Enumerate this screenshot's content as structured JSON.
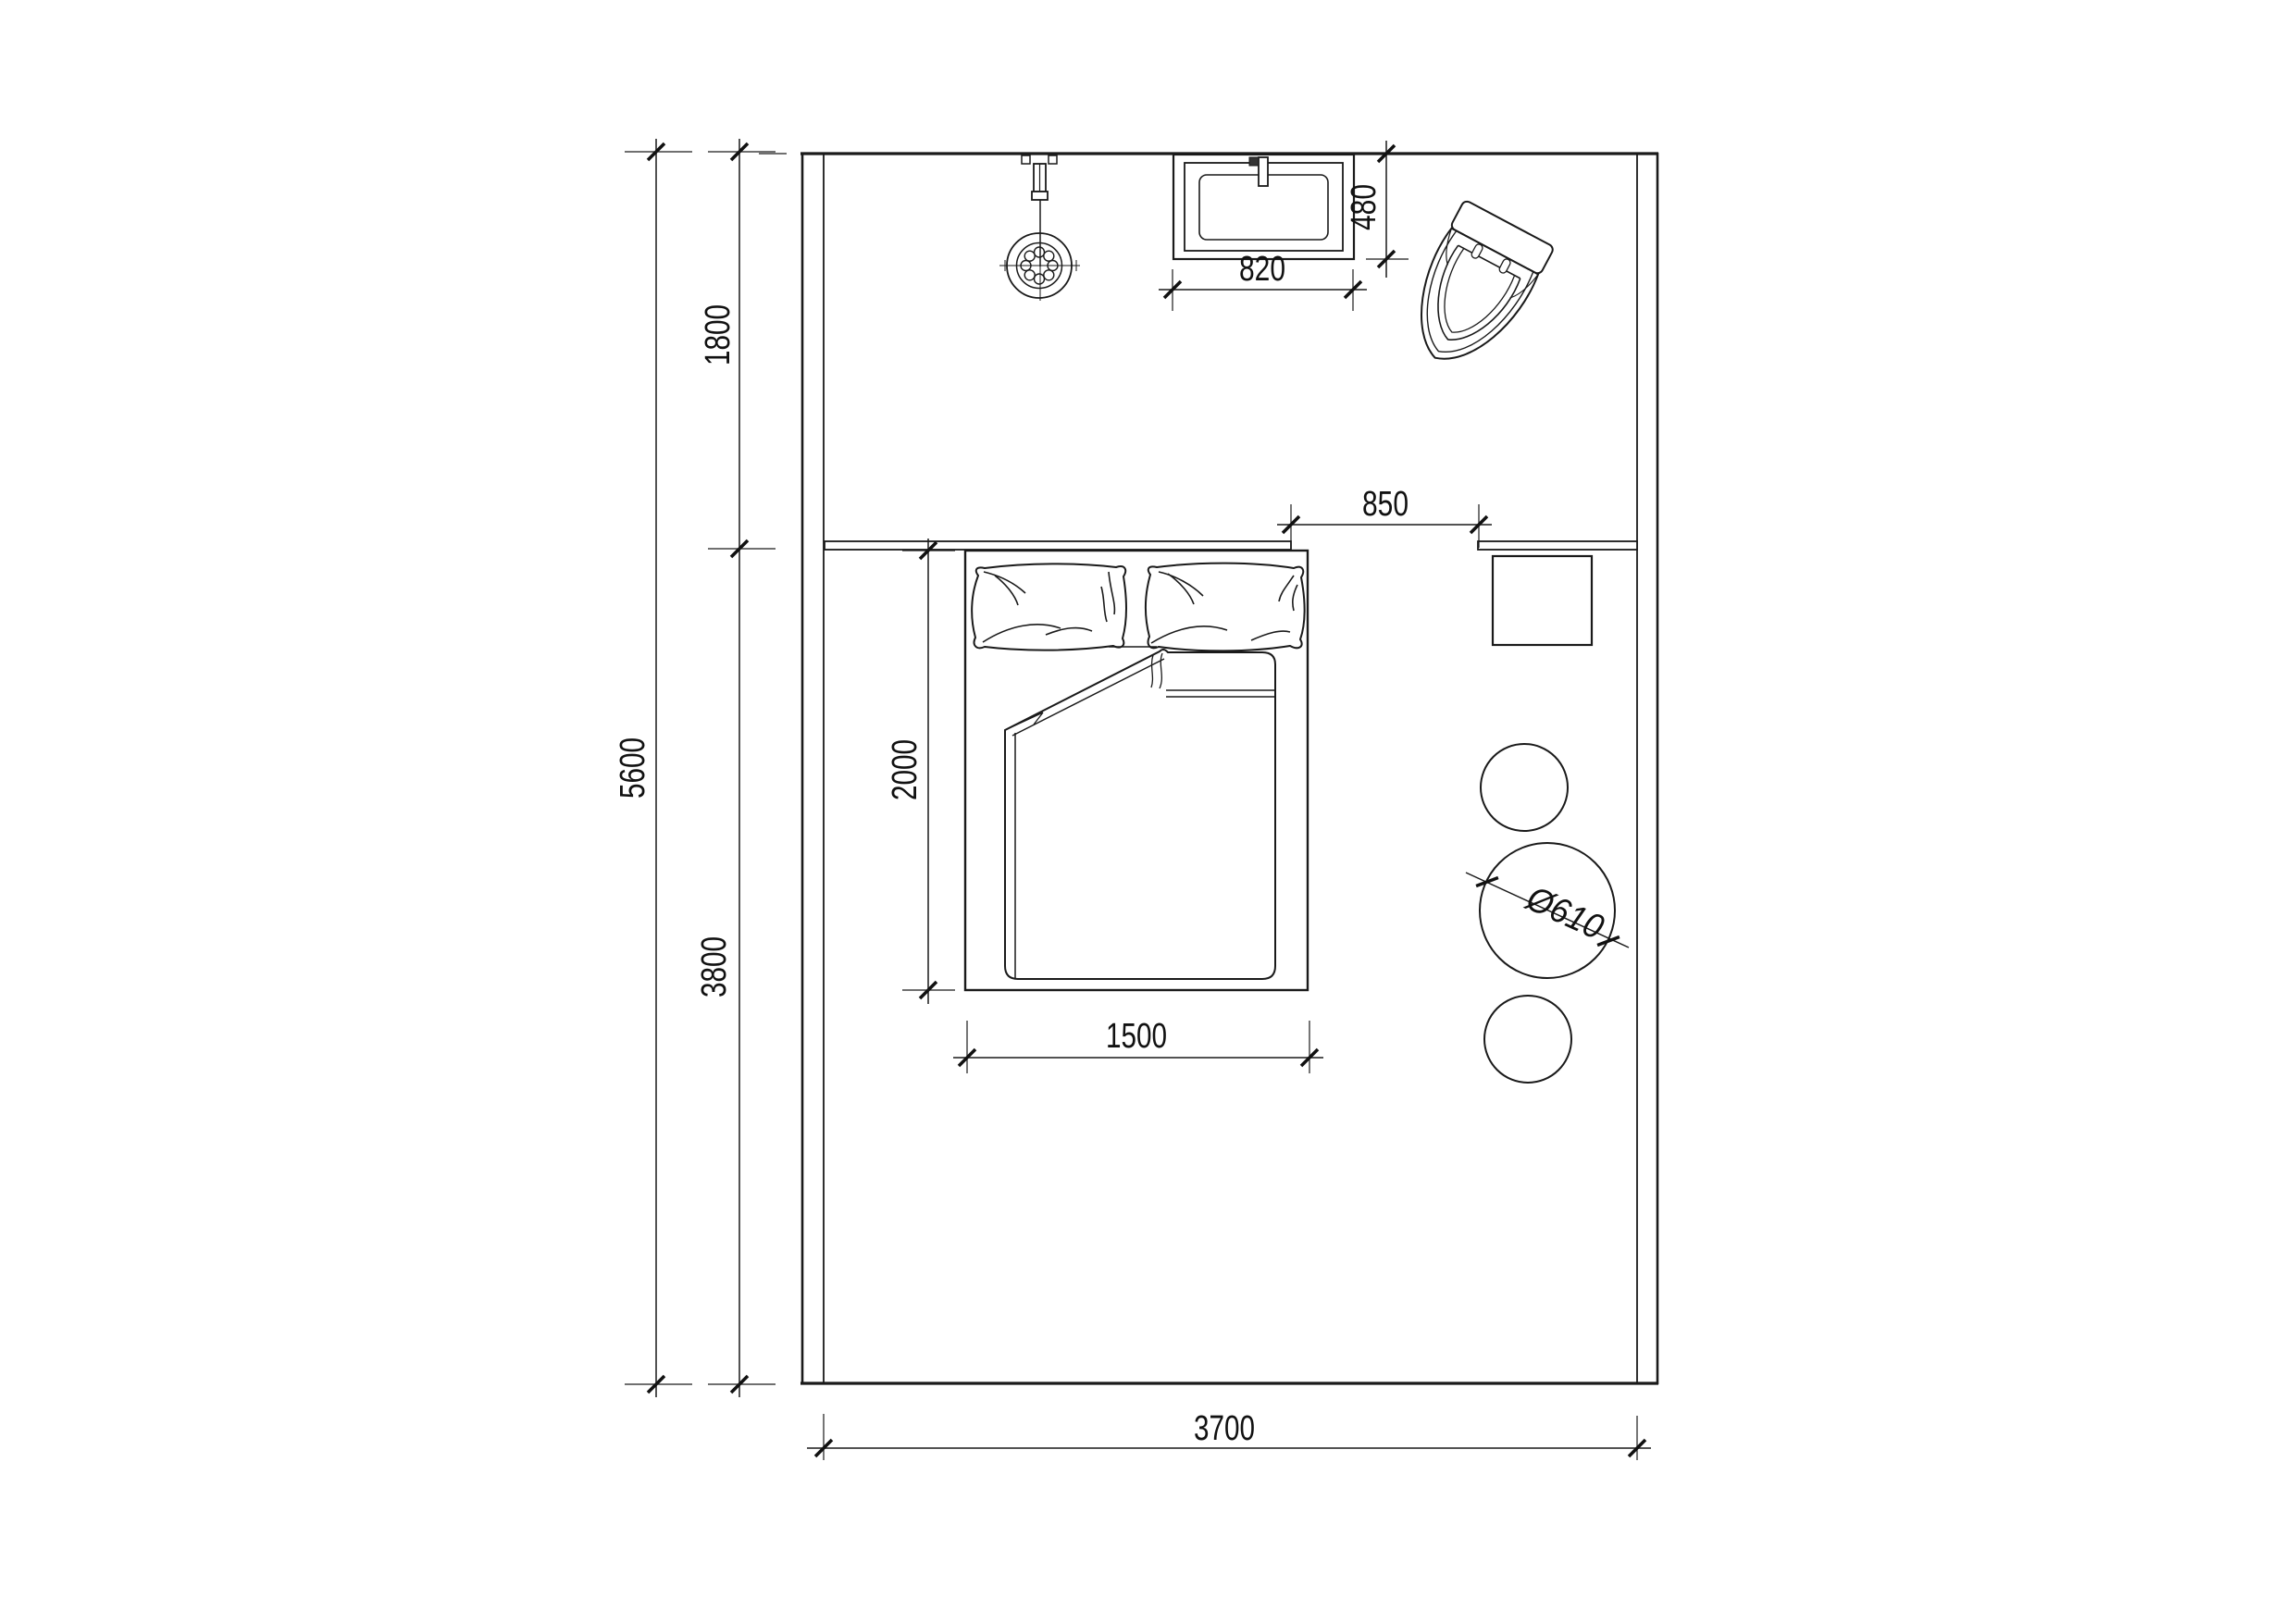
{
  "drawing": {
    "type": "architectural-floor-plan",
    "units": "mm",
    "colors": {
      "ink": "#1a1a1a",
      "paper": "#ffffff"
    },
    "dimensions": {
      "room_height_total": "5600",
      "bath_zone_depth": "1800",
      "bedroom_zone_depth": "3800",
      "room_width": "3700",
      "bed_length": "2000",
      "bed_width": "1500",
      "passage_opening": "850",
      "basin_width": "820",
      "basin_depth": "480",
      "stool_diameter": "Ø610"
    },
    "symbols": {
      "shower": "shower-head-symbol",
      "basin": "square-wash-basin-symbol",
      "toilet": "toilet-symbol",
      "bed": "double-bed-symbol",
      "desk": "bedside-table-symbol",
      "stools": "round-stool-symbols",
      "ledge": "wall-ledge-symbol"
    }
  }
}
